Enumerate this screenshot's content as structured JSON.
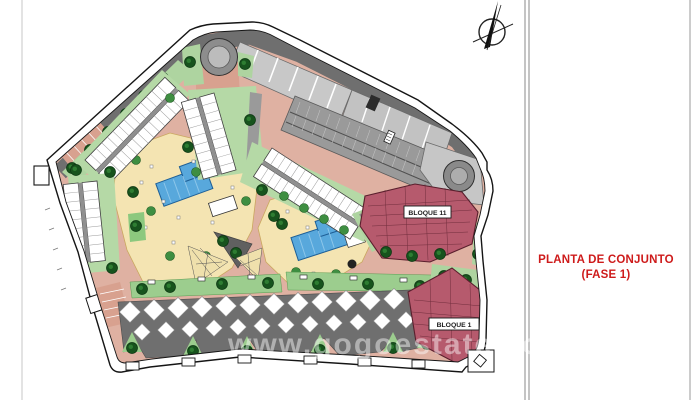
{
  "drawing": {
    "type": "site-plan",
    "watermark": "www.gogoestates.com",
    "buildings": {
      "bloque_11": "BLOQUE 11",
      "bloque_1": "BLOQUE 1"
    }
  },
  "title_block": {
    "line1": "PLANTA DE CONJUNTO",
    "line2": "(FASE 1)"
  },
  "colors": {
    "title_red": "#ce1b1b",
    "building_red": "#b65a6d",
    "building_red_outline": "#5a1f2d",
    "pool_blue": "#58a8dc",
    "road_pink": "#dfb1a2",
    "amenity_cream": "#f4e4b2",
    "grass_green": "#b5d9a6",
    "hedge_green": "#9ccd8e",
    "tree_green": "#17531d",
    "asphalt_gray": "#6f6f6f",
    "parking_light_gray": "#c8c8c8",
    "boundary_black": "#151515"
  },
  "icons": {
    "north_arrow": "north-arrow-compass"
  }
}
